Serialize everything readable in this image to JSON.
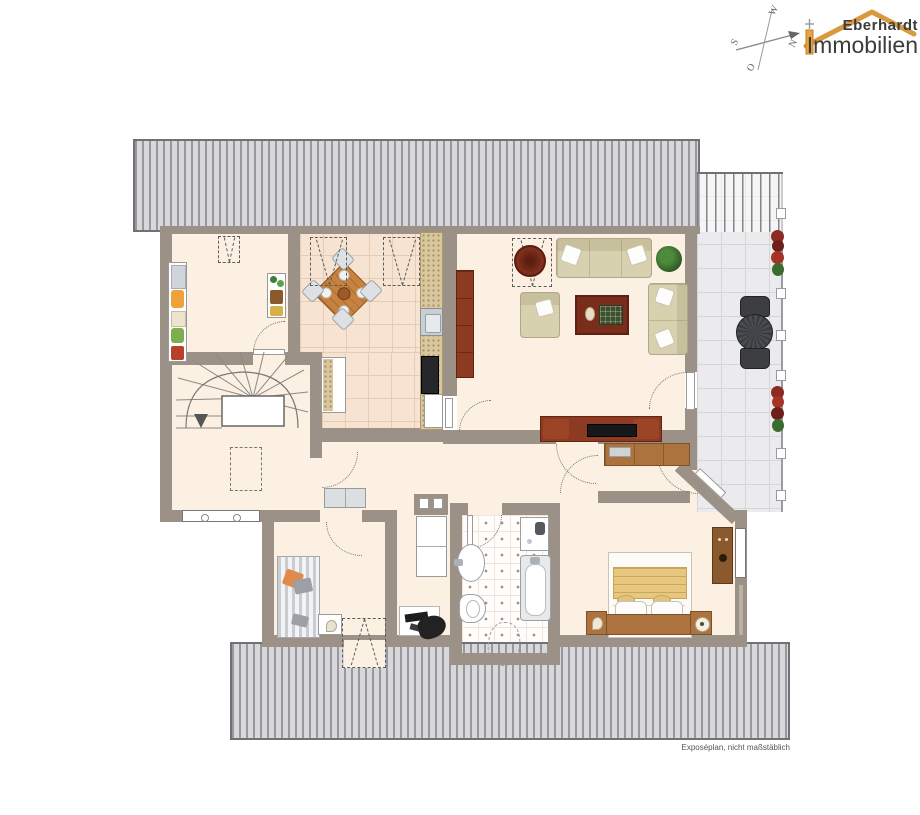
{
  "branding": {
    "line1": "Eberhardt",
    "line2": "Immobilien"
  },
  "compass": {
    "north": "N",
    "east": "O",
    "south": "S",
    "west": "W"
  },
  "footer": {
    "note": "Exposéplan, nicht maßstäblich"
  },
  "colors": {
    "wall": "#9c9186",
    "floor": "#fbf0e2",
    "kitchTile": "#f6e3d1",
    "kitchLine": "#e6ccb3",
    "bathDot": "#b5876b",
    "terrTile": "#ebebed",
    "terrLine": "#d5d5da",
    "hatchDark": "#97979d",
    "hatchLight": "#d8d8db",
    "hatchBorder": "#707075",
    "woodDark": "#8c3a22",
    "woodMid": "#ac733e",
    "rug": "#7b2d1c",
    "sofa": "#d8d1af",
    "sofaBorder": "#afa789",
    "blanket": "#e7c77f",
    "logoOrange": "#d8993f",
    "chimneyOrange": "#e9a33c"
  }
}
